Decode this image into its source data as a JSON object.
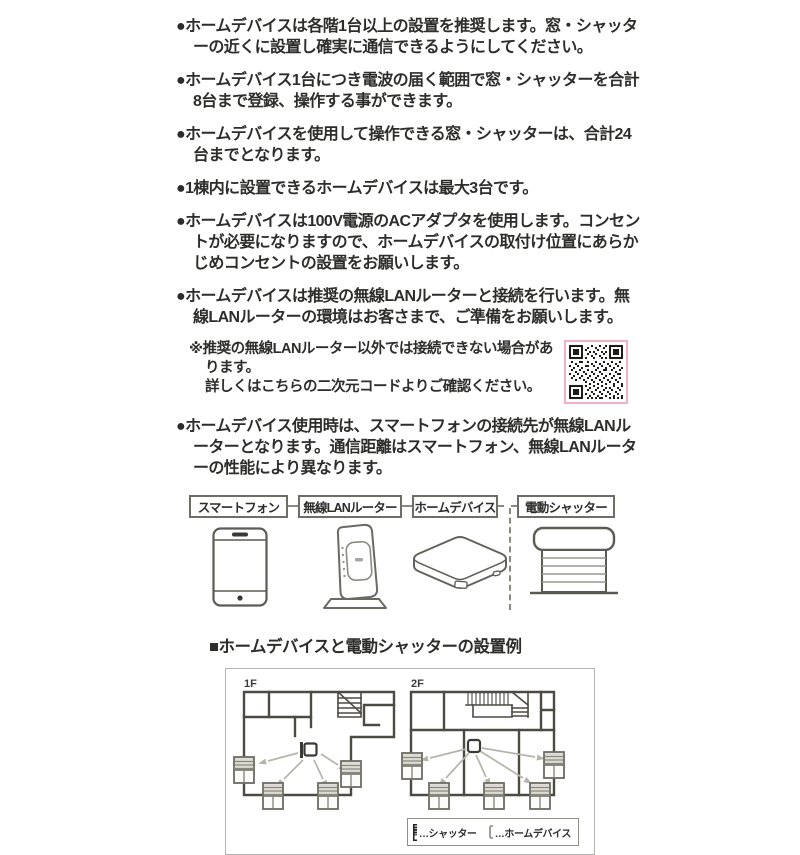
{
  "ui": {
    "bullet_marker": "●",
    "note_marker": "※"
  },
  "bullets": [
    "ホームデバイスは各階1台以上の設置を推奨します。窓・シャッターの近くに設置し確実に通信できるようにしてください。",
    "ホームデバイス1台につき電波の届く範囲で窓・シャッターを合計8台まで登録、操作する事ができます。",
    "ホームデバイスを使用して操作できる窓・シャッターは、合計24台までとなります。",
    "1棟内に設置できるホームデバイスは最大3台です。",
    "ホームデバイスは100V電源のACアダプタを使用します。コンセントが必要になりますので、ホームデバイスの取付け位置にあらかじめコンセントの設置をお願いします。",
    "ホームデバイスは推奨の無線LANルーターと接続を行います。無線LANルーターの環境はお客さまで、ご準備をお願いします。",
    "ホームデバイス使用時は、スマートフォンの接続先が無線LANルーターとなります。通信距離はスマートフォン、無線LANルーターの性能により異なります。"
  ],
  "note": {
    "line1": "推奨の無線LANルーター以外では接続できない場合があります。",
    "line2": "詳しくはこちらの二次元コードよりご確認ください。"
  },
  "diagram": {
    "labels": [
      "スマートフォン",
      "無線LANルーター",
      "ホームデバイス",
      "電動シャッター"
    ]
  },
  "install_example": {
    "heading": "■ホームデバイスと電動シャッターの設置例",
    "floors": [
      {
        "label": "1F"
      },
      {
        "label": "2F"
      }
    ],
    "legend": [
      {
        "icon": "shutter-icon",
        "label": "…シャッター"
      },
      {
        "icon": "home-device-icon",
        "label": "…ホームデバイス"
      }
    ]
  },
  "colors": {
    "text": "#2d2d2b",
    "qr_border": "#f3b0c1",
    "wall": "#4b4a43",
    "arrow": "#b5b4ab",
    "box_border": "#b2b2ae"
  }
}
